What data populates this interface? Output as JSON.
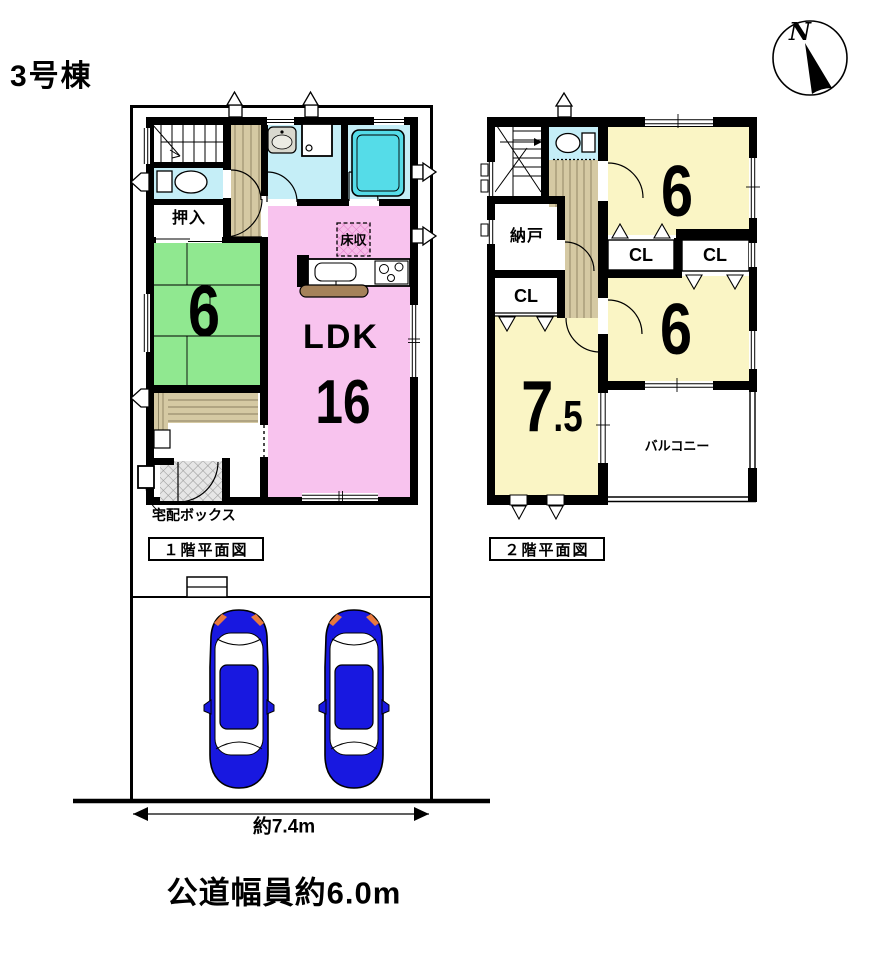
{
  "title": "3号棟",
  "compass": {
    "north": "N"
  },
  "floor1": {
    "caption": "１階平面図",
    "oshiire": "押入",
    "tatami_size": "6",
    "ldk_label": "LDK",
    "ldk_size": "16",
    "floor_storage": "床収",
    "delivery_box": "宅配ボックス"
  },
  "floor2": {
    "caption": "２階平面図",
    "room_top_size": "6",
    "room_mid_size": "6",
    "room_main_size_int": "7",
    "room_main_size_frac": ".5",
    "nando": "納戸",
    "cl_left": "CL",
    "cl_mid": "CL",
    "cl_right": "CL",
    "balcony": "バルコニー"
  },
  "dimensions": {
    "frontage": "約7.4m",
    "road_width": "公道幅員約6.0m"
  },
  "colors": {
    "ldk_pink": "#F8C3EE",
    "tatami_green": "#90E890",
    "room_yellow": "#FAF5C5",
    "wet_area_cyan": "#C5EEF7",
    "bathtub_cyan": "#55DCE8",
    "wood_tan": "#D5C9A3",
    "kitchen_brown": "#A5825A",
    "car_blue": "#1818E0"
  }
}
